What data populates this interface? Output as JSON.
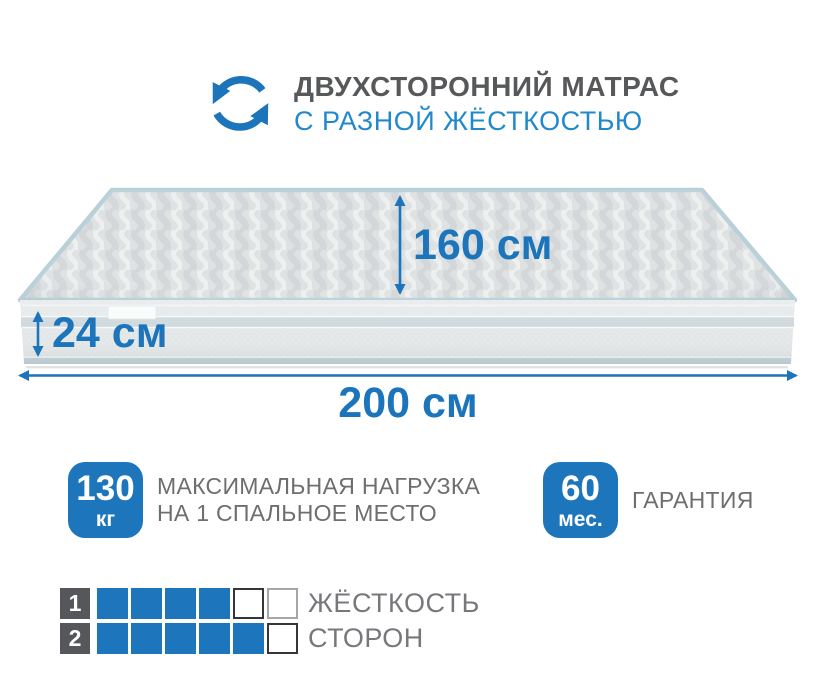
{
  "header": {
    "title": "ДВУХСТОРОННИЙ МАТРАС",
    "subtitle": "С РАЗНОЙ ЖЁСТКОСТЬЮ",
    "icon": "rotate-arrows-icon"
  },
  "mattress": {
    "top_dimension": "160 см",
    "height_dimension": "24 см",
    "width_dimension": "200 см"
  },
  "features": [
    {
      "badge_value": "130",
      "badge_unit": "кг",
      "label_lines": [
        "МАКСИМАЛЬНАЯ НАГРУЗКА",
        "НА 1 СПАЛЬНОЕ МЕСТО"
      ]
    },
    {
      "badge_value": "60",
      "badge_unit": "мес.",
      "label_lines": [
        "ГАРАНТИЯ"
      ]
    }
  ],
  "hardness_chart": {
    "type": "table",
    "scale_max": 6,
    "rows": [
      {
        "side": "1",
        "value": 4,
        "cells": [
          "filled",
          "filled",
          "filled",
          "filled",
          "empty-dark",
          "empty-light"
        ],
        "caption": "ЖЁСТКОСТЬ"
      },
      {
        "side": "2",
        "value": 5,
        "cells": [
          "filled",
          "filled",
          "filled",
          "filled",
          "filled",
          "empty-dark"
        ],
        "caption": "СТОРОН"
      }
    ]
  },
  "colors": {
    "accent": "#1c74ba",
    "subtitle-blue": "#2189cb",
    "text-gray": "#6d6e70",
    "title-gray": "#57585a",
    "label-dark": "#56575b",
    "badge-blue": "#1d76bb"
  }
}
